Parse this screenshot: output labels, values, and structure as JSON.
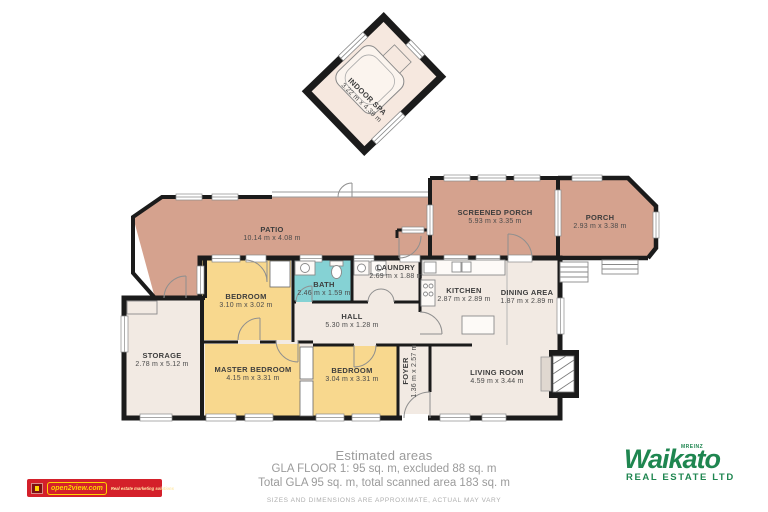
{
  "plan": {
    "rooms": {
      "indoor_spa": {
        "name": "INDOOR SPA",
        "dims": "3.22 m x 4.39 m"
      },
      "patio": {
        "name": "PATIO",
        "dims": "10.14 m x 4.08 m"
      },
      "screened_porch": {
        "name": "SCREENED PORCH",
        "dims": "5.93 m x 3.35 m"
      },
      "porch": {
        "name": "PORCH",
        "dims": "2.93 m x 3.38 m"
      },
      "bedroom1": {
        "name": "BEDROOM",
        "dims": "3.10 m x 3.02 m"
      },
      "bath": {
        "name": "BATH",
        "dims": "2.46 m x 1.59 m"
      },
      "laundry": {
        "name": "LAUNDRY",
        "dims": "2.69 m x 1.88 m"
      },
      "kitchen": {
        "name": "KITCHEN",
        "dims": "2.87 m x 2.89 m"
      },
      "dining": {
        "name": "DINING AREA",
        "dims": "1.87 m x 2.89 m"
      },
      "hall": {
        "name": "HALL",
        "dims": "5.30 m x 1.28 m"
      },
      "storage": {
        "name": "STORAGE",
        "dims": "2.78 m x 5.12 m"
      },
      "master_bedroom": {
        "name": "MASTER BEDROOM",
        "dims": "4.15 m x 3.31 m"
      },
      "bedroom2": {
        "name": "BEDROOM",
        "dims": "3.04 m x 3.31 m"
      },
      "foyer": {
        "name": "FOYER",
        "dims": "1.36 m x 2.57 m"
      },
      "living": {
        "name": "LIVING ROOM",
        "dims": "4.59 m x 3.44 m"
      }
    }
  },
  "footer": {
    "title": "Estimated areas",
    "line1": "GLA FLOOR 1: 95 sq. m, excluded 88 sq. m",
    "line2": "Total GLA 95 sq. m, total scanned area 183 sq. m",
    "disclaimer": "SIZES AND DIMENSIONS ARE APPROXIMATE, ACTUAL MAY VARY"
  },
  "branding": {
    "open2view": {
      "name": "open2view.com",
      "tagline": "Real estate marketing solutions"
    },
    "waikato": {
      "mreinz": "MREINZ",
      "name": "Waikato",
      "subtitle": "REAL ESTATE LTD"
    }
  },
  "colors": {
    "outdoor_floor": "#d5a28e",
    "bedroom_floor": "#f8d88e",
    "bath_floor": "#85d2d4",
    "interior_floor": "#f2eae3",
    "spa_floor": "#f6e8df",
    "wall": "#1b1b1b",
    "brand_red": "#d4202a",
    "brand_yellow": "#ffd400",
    "brand_green": "#1f8650"
  }
}
